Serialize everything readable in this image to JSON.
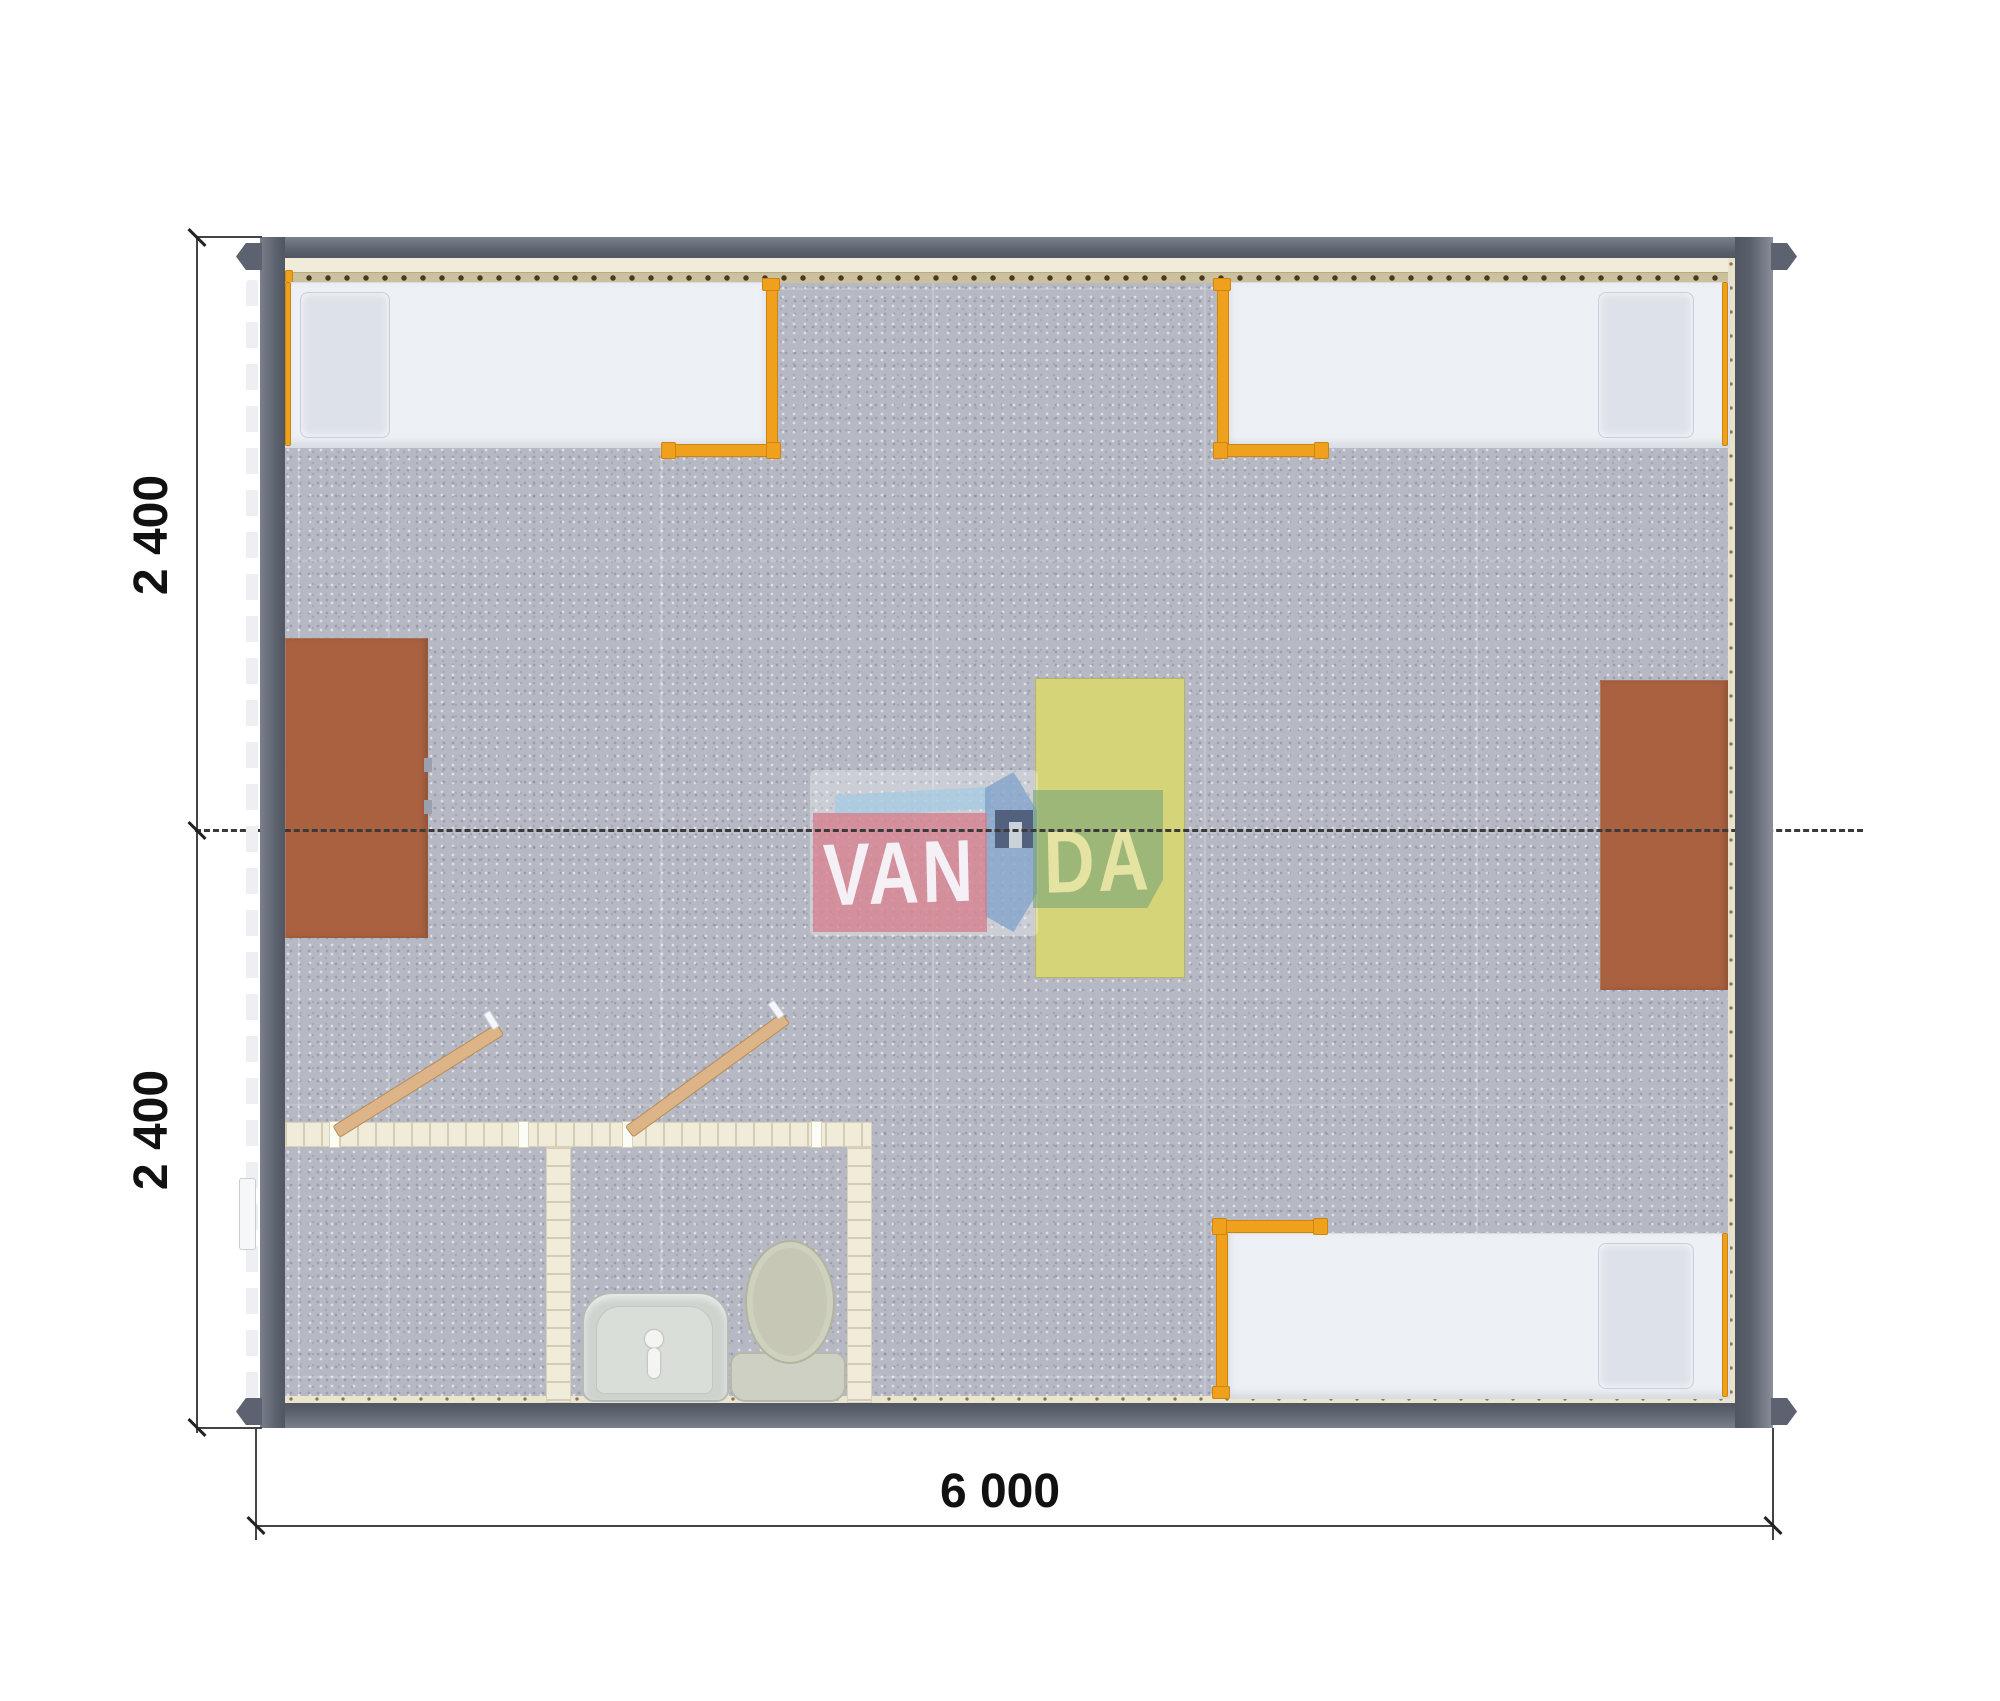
{
  "dimensions": {
    "left_top": "2 400",
    "left_bottom": "2 400",
    "bottom": "6 000"
  },
  "watermark": {
    "left_text": "VAN",
    "right_text": "DA"
  },
  "colors": {
    "wall": "#5d6270",
    "floor": "#b6b9c4",
    "orange": "#efa11d",
    "bed": "#edf0f4",
    "desk": "#a96140",
    "table": "#d6d478",
    "cream": "#f1ecd9",
    "door": "#dcb488",
    "logo_pink": "#d57d8a",
    "logo_green": "#76a478",
    "logo_blue": "#7da0c8",
    "logo_navy": "#4d5a76"
  },
  "furniture": [
    "bed-top-left",
    "bed-top-right",
    "bed-bottom-right",
    "desk-left",
    "desk-right",
    "table-center",
    "bathroom-left-room",
    "bathroom-toilet-room",
    "washbasin",
    "toilet",
    "door-left-room",
    "door-toilet-room"
  ]
}
